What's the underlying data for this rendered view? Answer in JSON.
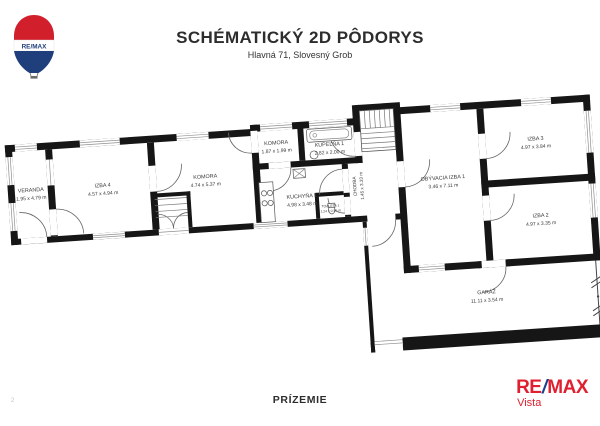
{
  "header": {
    "title": "SCHÉMATICKÝ 2D PÔDORYS",
    "subtitle": "Hlavná 71, Slovesný Grob"
  },
  "footer": {
    "floor_label": "PRÍZEMIE",
    "page_number": "2"
  },
  "branding": {
    "balloon_wordmark": "RE/MAX",
    "logo_re": "RE",
    "logo_slash": "/",
    "logo_max": "MAX",
    "logo_sub": "Vista",
    "remax_red": "#E02030",
    "remax_blue": "#1B3E8F"
  },
  "rooms": [
    {
      "name": "VERANDA",
      "dims": "1.95 x 4.79 m"
    },
    {
      "name": "IZBA 4",
      "dims": "4.57 x 4.94 m"
    },
    {
      "name": "KOMORA",
      "dims": "4.74 x 5.37 m"
    },
    {
      "name": "KOMORA",
      "dims": "1.87 x 1.99 m"
    },
    {
      "name": "KÚPEĽŇA 1",
      "dims": "2.82 x 2.00 m"
    },
    {
      "name": "KUCHYŇA 1",
      "dims": "4.98 x 3.48 m"
    },
    {
      "name": "TOALETA 1",
      "dims": "1.24 x 0.95 m"
    },
    {
      "name": "CHODBA",
      "dims": "1.45 x 3.33 m"
    },
    {
      "name": "OBÝVACIA IZBA 1",
      "dims": "3.46 x 7.11 m"
    },
    {
      "name": "IZBA 3",
      "dims": "4.97 x 3.84 m"
    },
    {
      "name": "IZBA 2",
      "dims": "4.97 x 3.35 m"
    },
    {
      "name": "GARÁŽ",
      "dims": "11.11 x 3.54 m"
    }
  ]
}
